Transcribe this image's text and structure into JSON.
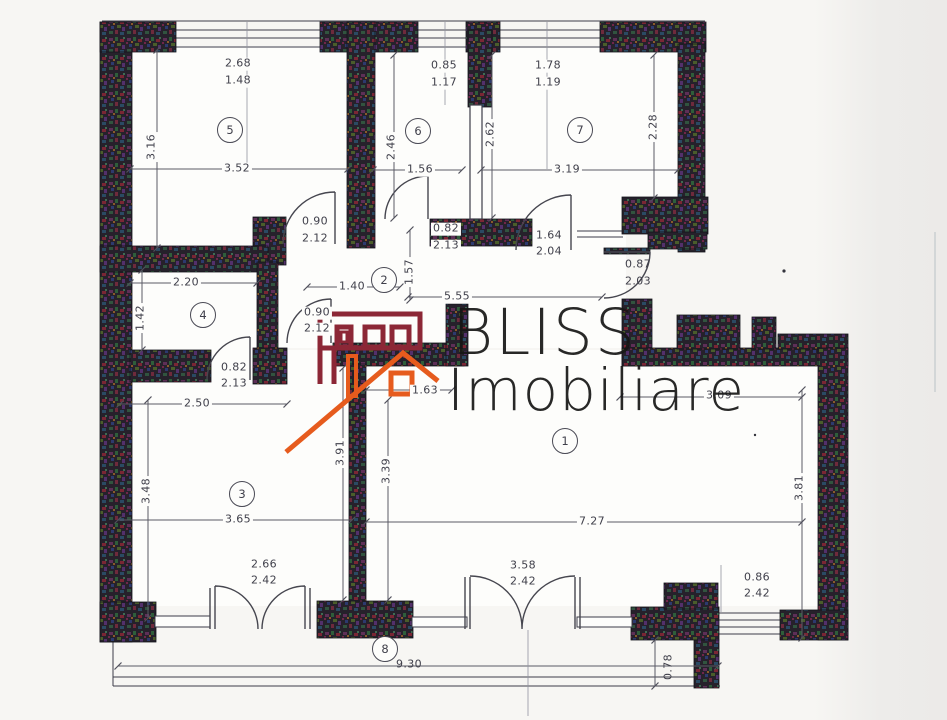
{
  "watermark": {
    "brand": "BLISS",
    "brand_sub": "Imobiliare"
  },
  "colors": {
    "wall": "#26212b",
    "logo_red": "#8c2736",
    "logo_orange": "#e65b1d",
    "dim_line": "#5a5a66",
    "paper": "#f7f6f3"
  },
  "entrance_door": {
    "width": "0.87",
    "height": "2.03"
  },
  "rooms": {
    "r1": {
      "number": "1",
      "dim_width_top": "3.09",
      "dim_width": "7.27",
      "dim_height_left": "3.39",
      "dim_height_right": "3.81",
      "opening": "1.63",
      "door": {
        "width": "3.58",
        "height": "2.42"
      },
      "window": {
        "width": "0.86",
        "height": "2.42"
      }
    },
    "r2": {
      "number": "2",
      "dim_width_a": "1.40",
      "dim_height": "1.57",
      "dim_width_b": "5.55",
      "door_to_r3": {
        "width": "0.90",
        "height": "2.12"
      }
    },
    "r3": {
      "number": "3",
      "dim_height": "3.48",
      "dim_width": "3.65",
      "dim_width_top": "2.50",
      "dim_height_right": "3.91",
      "door": {
        "width": "2.66",
        "height": "2.42"
      }
    },
    "r4": {
      "number": "4",
      "dim_width": "2.20",
      "dim_height": "1.42",
      "door": {
        "width": "0.82",
        "height": "2.13"
      }
    },
    "r5": {
      "number": "5",
      "window": {
        "width": "2.68",
        "height": "1.48"
      },
      "dim_height": "3.16",
      "dim_width": "3.52",
      "door": {
        "width": "0.90",
        "height": "2.12"
      }
    },
    "r6": {
      "number": "6",
      "window": {
        "width": "0.85",
        "height": "1.17"
      },
      "dim_height": "2.46",
      "dim_width": "1.56",
      "door": {
        "width": "0.82",
        "height": "2.13"
      }
    },
    "r7": {
      "number": "7",
      "window": {
        "width": "1.78",
        "height": "1.19"
      },
      "dim_height_left": "2.62",
      "dim_height_right": "2.28",
      "dim_width": "3.19",
      "door": {
        "width": "1.64",
        "height": "2.04"
      }
    },
    "r8": {
      "number": "8",
      "dim_width": "9.30",
      "dim_depth": "0.78"
    }
  }
}
